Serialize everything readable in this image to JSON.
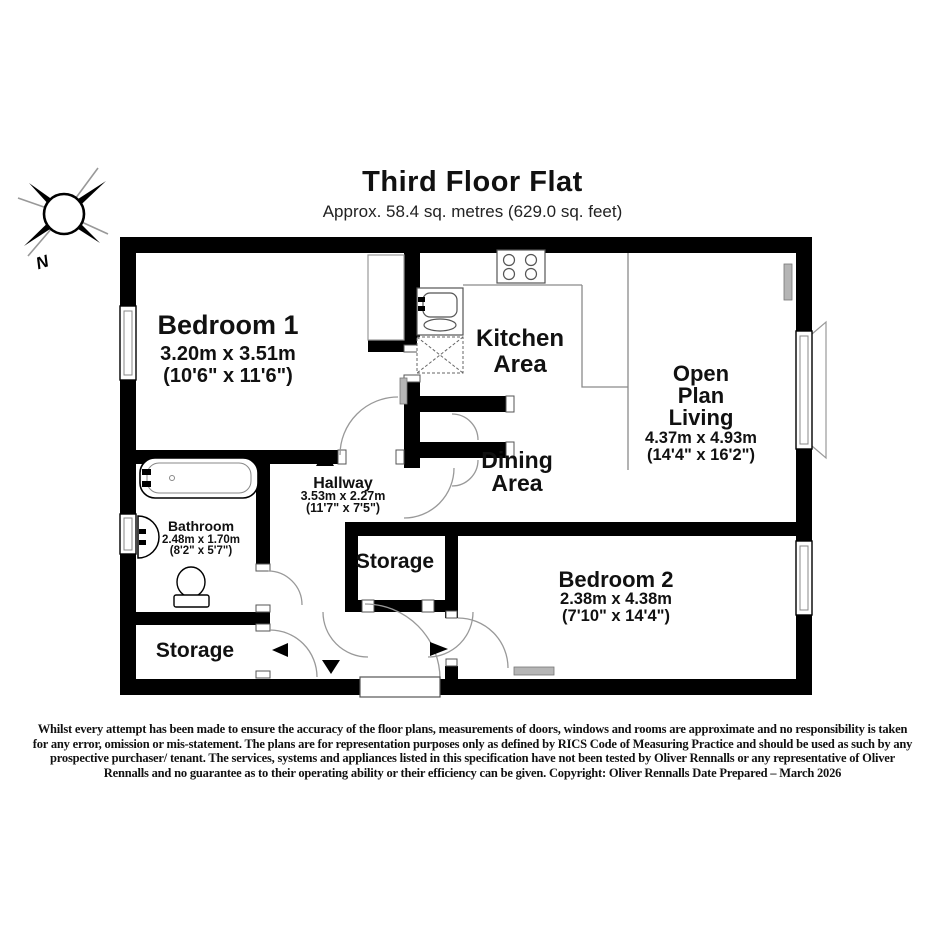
{
  "title": {
    "heading": "Third Floor Flat",
    "subtitle": "Approx. 58.4 sq. metres (629.0 sq. feet)"
  },
  "compass": {
    "label": "N"
  },
  "rooms": {
    "bedroom1": {
      "name": "Bedroom 1",
      "metric": "3.20m x 3.51m",
      "imperial": "(10'6\" x 11'6\")"
    },
    "kitchen": {
      "lines": [
        "Kitchen",
        "Area"
      ]
    },
    "open_plan_living": {
      "lines": [
        "Open",
        "Plan",
        "Living"
      ],
      "metric": "4.37m x 4.93m",
      "imperial": "(14'4\" x 16'2\")"
    },
    "dining": {
      "lines": [
        "Dining",
        "Area"
      ]
    },
    "hallway": {
      "name": "Hallway",
      "metric": "3.53m x 2.27m",
      "imperial": "(11'7\" x 7'5\")"
    },
    "bathroom": {
      "name": "Bathroom",
      "metric": "2.48m x 1.70m",
      "imperial": "(8'2\" x 5'7\")"
    },
    "storage_center": {
      "name": "Storage"
    },
    "storage_left": {
      "name": "Storage"
    },
    "bedroom2": {
      "name": "Bedroom 2",
      "metric": "2.38m x 4.38m",
      "imperial": "(7'10\" x 14'4\")"
    }
  },
  "disclaimer": {
    "lines": [
      "Whilst every attempt has been made to ensure the accuracy of the floor plans, measurements of doors, windows and rooms are approximate and no responsibility is taken",
      "for any error, omission or mis-statement. The plans are for representation purposes only as defined by RICS Code of Measuring Practice and should be used as such by any",
      "prospective purchaser/ tenant. The services, systems and appliances listed in this specification have not been tested by Oliver Rennalls or any representative of Oliver",
      "Rennalls and no guarantee as to their operating ability or their efficiency can be given. Copyright: Oliver Rennalls Date Prepared – March 2026"
    ]
  },
  "colors": {
    "wall": "#000000",
    "floor": "#ffffff",
    "thin_line": "#8a8a8a",
    "radiator": "#b5b5b5",
    "text": "#111111"
  }
}
